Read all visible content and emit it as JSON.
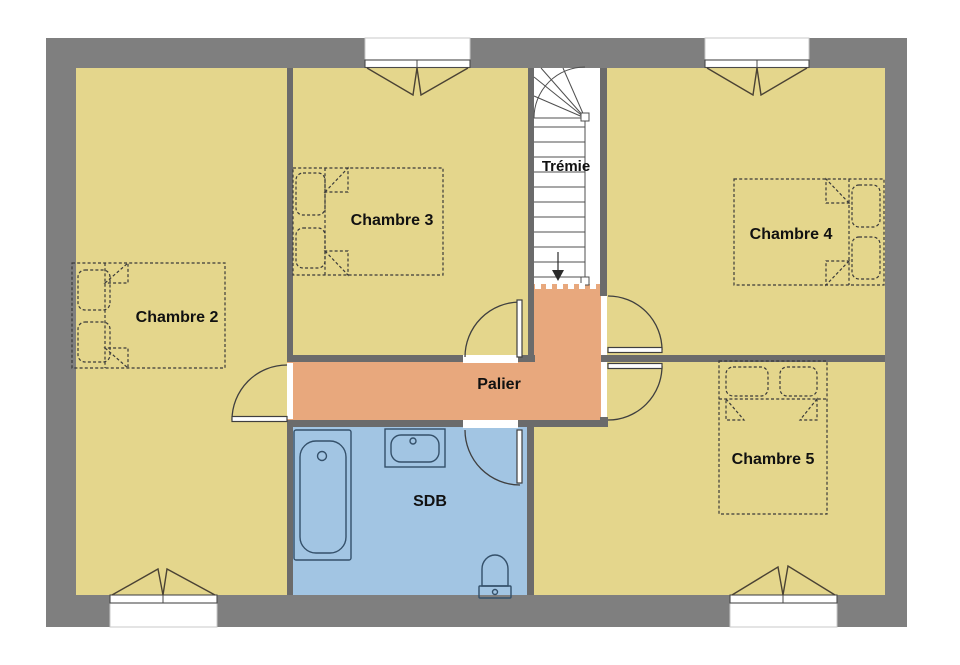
{
  "plan": {
    "rooms": [
      {
        "id": "chambre2",
        "label": "Chambre 2",
        "type": "bedroom"
      },
      {
        "id": "chambre3",
        "label": "Chambre 3",
        "type": "bedroom"
      },
      {
        "id": "chambre4",
        "label": "Chambre 4",
        "type": "bedroom"
      },
      {
        "id": "chambre5",
        "label": "Chambre 5",
        "type": "bedroom"
      },
      {
        "id": "palier",
        "label": "Palier",
        "type": "hallway"
      },
      {
        "id": "sdb",
        "label": "SDB",
        "type": "bathroom"
      },
      {
        "id": "tremie",
        "label": "Trémie",
        "type": "stairwell"
      }
    ],
    "colors": {
      "bedroom_fill": "#e4d68c",
      "hallway_fill": "#e8a87d",
      "bathroom_fill": "#a2c5e3",
      "stairwell_fill": "#ffffff",
      "outer_wall": "#7f7f7f",
      "inner_wall": "#6b6b6b",
      "label_color": "#111111"
    }
  }
}
